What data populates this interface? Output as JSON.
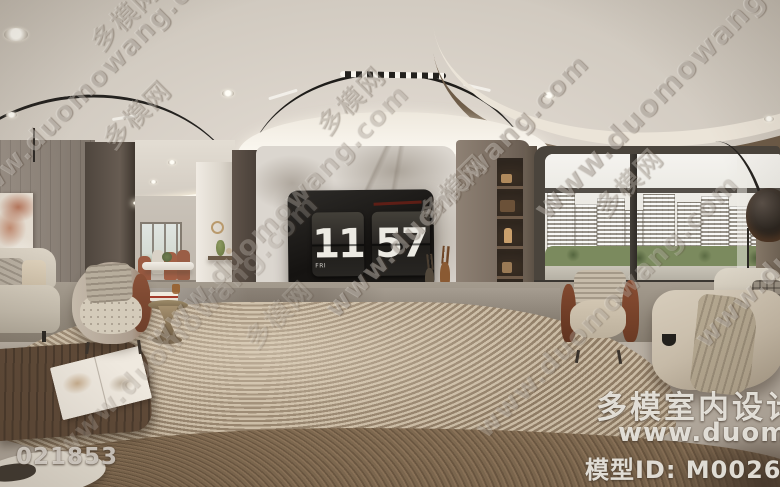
{
  "clock": {
    "day": "FRI",
    "hours": "11",
    "minutes": "57"
  },
  "watermarks": {
    "diagonal_url": "www.duomowang.com",
    "stamp_cn": "多模网",
    "brand_cn": "多模室内设计",
    "brand_url": "www.duomowang",
    "model_id": "模型ID: M0026779",
    "serial": "021853"
  },
  "colors": {
    "ceiling": "#dcd5cc",
    "wood_wall": "#8d8176",
    "dark_wood": "#544a41",
    "marble_wall": "#dbd6cf",
    "tv_screen": "#1b1916",
    "clock_digit": "#eceae3",
    "niche_glow": "#d7a05f",
    "leather_accent": "#7c452e",
    "rug_dark": "#8f7c65",
    "rug_light": "#c9baa3",
    "floor_wood": "#74604a",
    "greenery": "#7b8a5e"
  }
}
